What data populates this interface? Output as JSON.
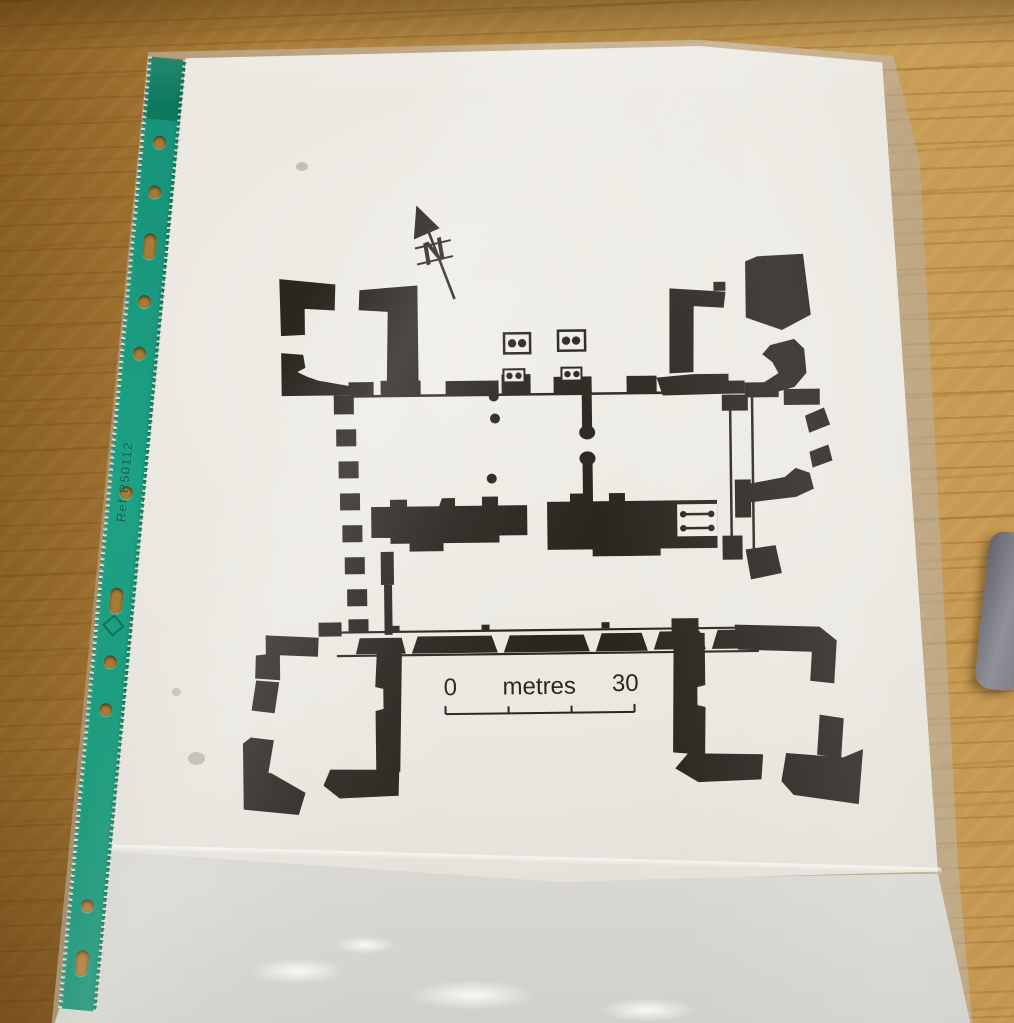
{
  "plan": {
    "north_label": "N",
    "scale_bar": {
      "zero_label": "0",
      "unit_label": "metres",
      "end_label": "30"
    }
  },
  "sleeve": {
    "strip_ref_text": "Ref R50112"
  },
  "icons": {
    "north_arrow": "arrow-with-N",
    "strip_logo": "diamond-mark"
  },
  "colors": {
    "wood": "#b08340",
    "strip_green": "#1da184",
    "paper": "#ece8e0",
    "ink": "#2b2620",
    "pocket_grey": "#d2d0ca",
    "grey_object": "#8b8b91"
  }
}
